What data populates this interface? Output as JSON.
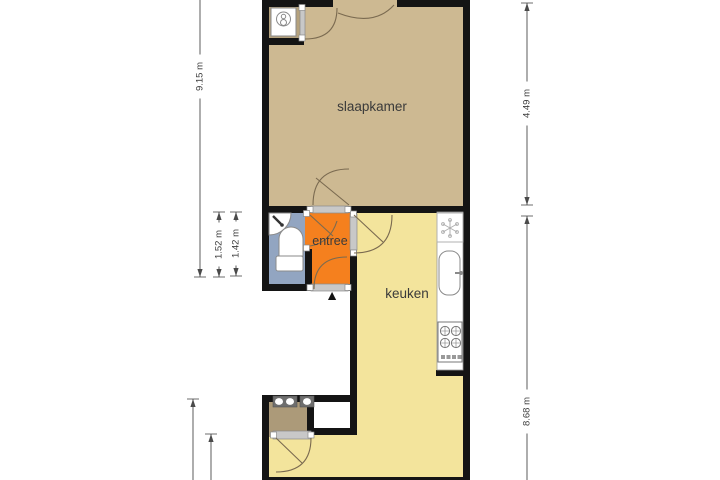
{
  "plan_type": "floor-plan",
  "rooms": {
    "slaapkamer": {
      "label": "slaapkamer",
      "floor_color": "#cdb992"
    },
    "entree": {
      "label": "entree",
      "floor_color": "#f5801e"
    },
    "keuken": {
      "label": "keuken",
      "floor_color": "#f3e49c"
    },
    "toilet": {
      "floor_color": "#92a5c1",
      "fixtures": [
        "corner-sink-icon",
        "toilet-icon"
      ]
    },
    "closet_top": {
      "floor_color": "#b5a27d",
      "fixtures": [
        "boiler-icon"
      ]
    },
    "closet_bottom": {
      "floor_color": "#ac9a79",
      "fixtures": [
        "washbasin-icon"
      ]
    },
    "living_area": {
      "floor_color": "#f3e49c"
    }
  },
  "kitchen_fixtures": [
    "extractor-fan-icon",
    "kitchen-sink-icon",
    "stove-icon"
  ],
  "dimensions": {
    "left_total": "9.15 m",
    "left_inner_1": "1.52 m",
    "left_inner_2": "1.42 m",
    "right_top": "4.49 m",
    "right_bottom": "8.68 m"
  },
  "markers": {
    "entrance_arrow": "▲"
  },
  "colors": {
    "wall": "#141414",
    "threshold": "#c8c8c8",
    "door_arc": "#7a6a50",
    "dimension_text": "#3d3d3d",
    "outside": "#ffffff"
  }
}
